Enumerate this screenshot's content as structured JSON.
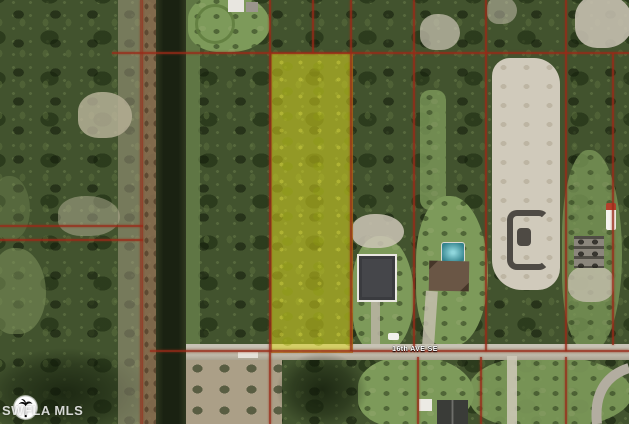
{
  "map": {
    "type": "aerial-parcel-photo",
    "road_label": "16th AVE SE",
    "watermark": {
      "text": "SWFLA MLS",
      "logo": "palm-tree-circle-logo"
    },
    "highlighted_parcel": {
      "fill_color": "#dedb1e",
      "outline_color": "#9a2a18",
      "opacity": 0.52
    },
    "colors": {
      "parcel_line": "#9a2a18",
      "canal_water": "#1a2212",
      "road_surface": "#b7b1a2",
      "vegetation": "#42532e",
      "cleared_sand": "#d0cabb",
      "pool_water": "#35848e",
      "road_label_text": "#ffffff"
    },
    "features": [
      "tree-cover",
      "drainage-canal",
      "dirt-berm",
      "highlighted-parcel",
      "road-16th-ave-se",
      "house-dark-roof",
      "house-with-pool",
      "swimming-pool",
      "cleared-sand-lot",
      "house-east",
      "house-south",
      "parcel-boundary-grid"
    ]
  }
}
